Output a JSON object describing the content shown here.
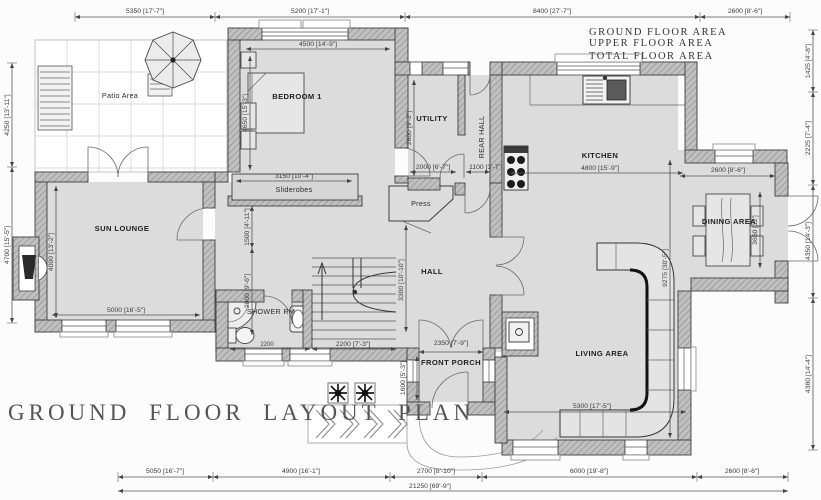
{
  "title": "GROUND FLOOR LAYOUT PLAN",
  "area_summary": {
    "ground": "GROUND FLOOR AREA",
    "upper": "UPPER FLOOR AREA",
    "total": "TOTAL FLOOR AREA"
  },
  "rooms": {
    "patio": "Patio Area",
    "bedroom": "BEDROOM 1",
    "sliderobes": "Sliderobes",
    "utility": "UTILITY",
    "rear_hall": "REAR HALL",
    "kitchen": "KITCHEN",
    "dining": "DINING AREA",
    "sun_lounge": "SUN LOUNGE",
    "press": "Press",
    "hall": "HALL",
    "shower": "SHOWER RM",
    "porch": "FRONT PORCH",
    "living": "LIVING AREA"
  },
  "dims": {
    "top": [
      "5350 [17'-7\"]",
      "5200 [17'-1\"]",
      "8400 [27'-7\"]",
      "2600 [8'-6\"]"
    ],
    "bottom": [
      "5050 [16'-7\"]",
      "4900 [16'-1\"]",
      "2700 [8'-10\"]",
      "6000 [19'-8\"]",
      "2600 [8'-6\"]"
    ],
    "bottom_total": "21250 [69'-9\"]",
    "left": [
      "4250 [13'-11\"]",
      "4700 [15'-5\"]"
    ],
    "right": [
      "1425 [4'-8\"]",
      "2225 [7'-4\"]",
      "4350 [14'-3\"]",
      "4380 [14'-4\"]"
    ],
    "bedroom_w": "4500 [14'-9\"]",
    "bedroom_h": "4650 [15'-3\"]",
    "sliderobes_w": "3150 [10'-4\"]",
    "landing_h": "1500 [4'-11\"]",
    "shower_h": "2900 [9'-6\"]",
    "shower_w": "2200",
    "utility_h": "2800 [9'-2\"]",
    "utility_w": "2000 [6'-7\"]",
    "rear_hall_w": "1100 [3'-7\"]",
    "kitchen_w": "4800 [15'-9\"]",
    "dining_w": "2600 [8'-6\"]",
    "dining_h": "3650 [12']",
    "sun_w": "5000 [16'-5\"]",
    "sun_h": "4000 [13'-2\"]",
    "hall_h": "3300 [10'-10\"]",
    "stairs_w": "2200 [7'-3\"]",
    "porch_w": "2350 [7'-9\"]",
    "porch_h": "1600 [5'-3\"]",
    "living_w": "5300 [17'-5\"]",
    "living_h": "9275 [30'-5\"]"
  },
  "colors": {
    "floor": "#dcdcdc",
    "wall_fill": "#bdbdbd",
    "line": "#3f3f3f",
    "dim_text": "#3d3d3d",
    "background": "#fcfcfc"
  }
}
